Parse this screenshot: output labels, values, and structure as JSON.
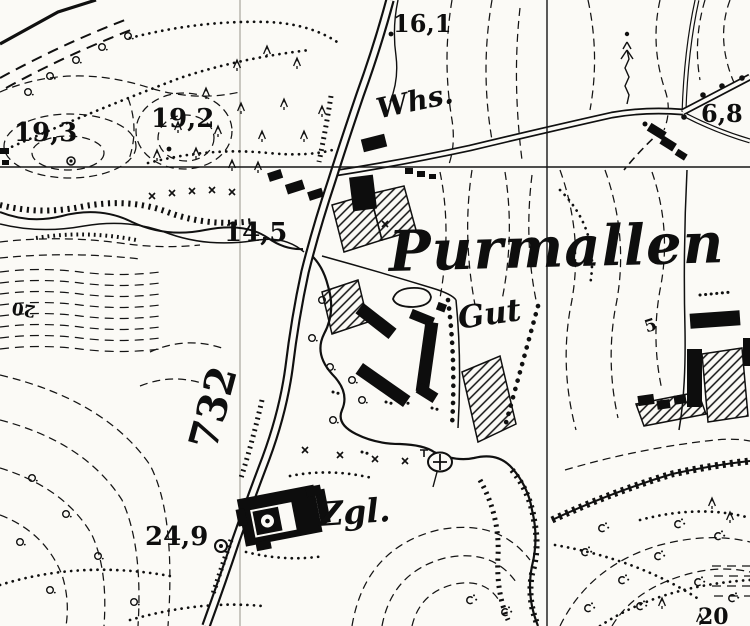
{
  "colors": {
    "paper": "#fbfaf6",
    "ink": "#101010",
    "fold_line": "#c9c7c0"
  },
  "labels": {
    "place": {
      "purmallen": "Purmallen",
      "gut": "Gut",
      "wirtshaus": "Whs.",
      "ziegelei": "Zgl."
    },
    "elevation": {
      "pt161": "16,1",
      "pt193": "19,3",
      "pt192": "19,2",
      "pt145": "14,5",
      "pt68": "6,8",
      "pt249": "24,9"
    },
    "road": {
      "number732": "732"
    },
    "contour": {
      "c20_left": "20",
      "c5_right": "5",
      "c20_bottom": "20"
    }
  },
  "legend": {
    "main_road": "double-line road",
    "grid_line": "survey grid line",
    "contour_line": "dashed contour",
    "vegetation_boundary": "dotted line",
    "stream": "wavy line with toothed banks",
    "embankment": "toothed tick line",
    "chapel_symbol": "circle with cross",
    "benchmark_symbol": "double circle with dot",
    "spot_height_symbol": "dot / circled dot",
    "building": "black footprint",
    "garden_plot": "hatched polygon",
    "conifer_tree": "fir symbol",
    "deciduous_tree": "circle symbol",
    "scrub": "bush symbol with dots",
    "tree_row": "beaded line"
  }
}
